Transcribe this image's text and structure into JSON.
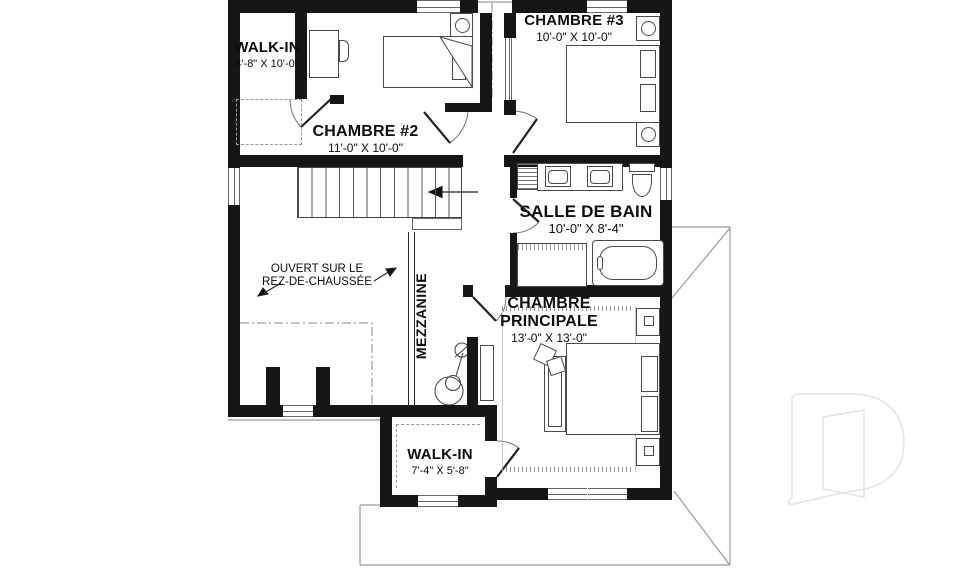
{
  "rooms": {
    "walk_in_top": {
      "name": "WALK-IN",
      "dims": "4'-8\" X 10'-0\""
    },
    "chambre_2": {
      "name": "CHAMBRE #2",
      "dims": "11'-0\" X 10'-0\""
    },
    "chambre_3": {
      "name": "CHAMBRE #3",
      "dims": "10'-0\" X 10'-0\""
    },
    "salle_de_bain": {
      "name": "SALLE DE BAIN",
      "dims": "10'-0\" X 8'-4\""
    },
    "chambre_principale": {
      "name": "CHAMBRE PRINCIPALE",
      "dims": "13'-0\" X 13'-0\""
    },
    "walk_in_bottom": {
      "name": "WALK-IN",
      "dims": "7'-4\" X 5'-8\""
    }
  },
  "annotations": {
    "mezzanine": "MEZZANINE",
    "open_to_below_line1": "OUVERT SUR LE",
    "open_to_below_line2": "REZ-DE-CHAUSSÉE"
  },
  "watermark": {
    "glyph": "D"
  },
  "colors": {
    "wall": "#161616",
    "line": "#555555",
    "roof": "#888888",
    "watermark": "#e3e3e3"
  }
}
